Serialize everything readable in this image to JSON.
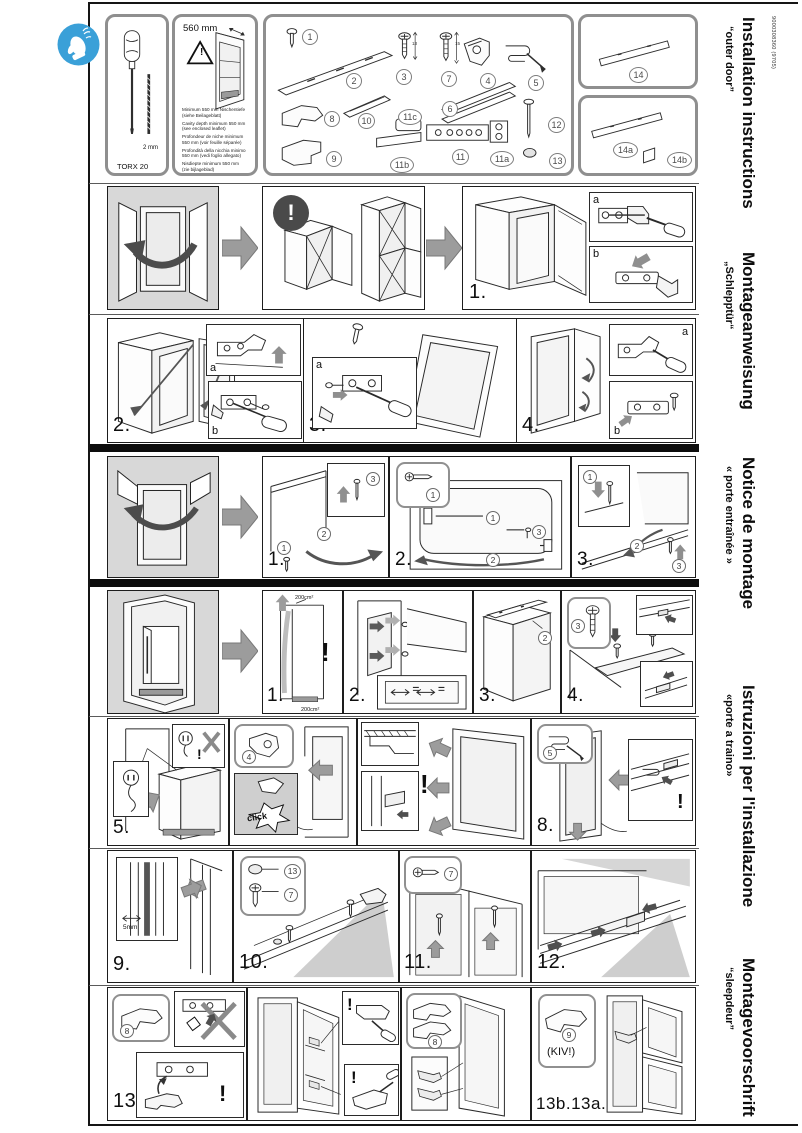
{
  "meta": {
    "doc_number": "9000308360 (9705)"
  },
  "sidebar": {
    "entries": [
      {
        "title": "Installation instructions",
        "subtitle": "“outer door”"
      },
      {
        "title": "Montageanweisung",
        "subtitle": "„Schlepptür“"
      },
      {
        "title": "Notice de montage",
        "subtitle": "« porte entraînée »"
      },
      {
        "title": "Istruzioni per l'installazione",
        "subtitle": "«porte a traino»"
      },
      {
        "title": "Montagevoorschrift",
        "subtitle": "“sleepdeur”"
      }
    ]
  },
  "tools": {
    "tool_name": "TORX 20",
    "bit_size": "2 mm"
  },
  "niche": {
    "width_label": "560 mm",
    "warning_mark": "!",
    "notes": [
      {
        "l1": "Minimum 550 mm Nischentiefe",
        "l2": "(siehe Beilageblatt)"
      },
      {
        "l1": "Cavity depth minimum 550 mm",
        "l2": "(see enclosed leaflet)"
      },
      {
        "l1": "Profondeur de niche minimum",
        "l2": "550 mm (voir feuille séparée)"
      },
      {
        "l1": "Profondità della nicchia minimo",
        "l2": "550 mm (vedi foglio allegato)"
      },
      {
        "l1": "Nisdiepte minimum 550 mm",
        "l2": "(zie bijlageblad)"
      }
    ]
  },
  "parts": {
    "p1": "1",
    "p2": "2",
    "p3": "3",
    "p4": "4",
    "p5": "5",
    "p6": "6",
    "p7": "7",
    "p8": "8",
    "p9": "9",
    "p10": "10",
    "p11": "11",
    "p11a": "11a",
    "p11b": "11b",
    "p11c": "11c",
    "p12": "12",
    "p13": "13",
    "p14": "14",
    "p14a": "14a",
    "p14b": "14b",
    "dim_p3": "13",
    "dim_p7": "15"
  },
  "steps": {
    "outer": [
      "1.",
      "2.",
      "3.",
      "4."
    ],
    "door": [
      "1.",
      "2.",
      "3."
    ],
    "main": [
      "1.",
      "2.",
      "3.",
      "4.",
      "5.",
      "6. 7.",
      "8.",
      "9.",
      "10.",
      "11.",
      "12.",
      "13.",
      "13b.13a."
    ]
  },
  "callouts": {
    "n1": "1",
    "n2": "2",
    "n3": "3",
    "n4": "4",
    "n5": "5",
    "n7": "7",
    "n8": "8",
    "n9": "9",
    "n13": "13"
  },
  "insets": {
    "a": "a",
    "b": "b"
  },
  "annotations": {
    "excl": "!",
    "vent_top": "200cm²",
    "vent_bottom": "200cm²",
    "click": "click",
    "gap": "5mm",
    "kiv": "(KIV!)"
  }
}
